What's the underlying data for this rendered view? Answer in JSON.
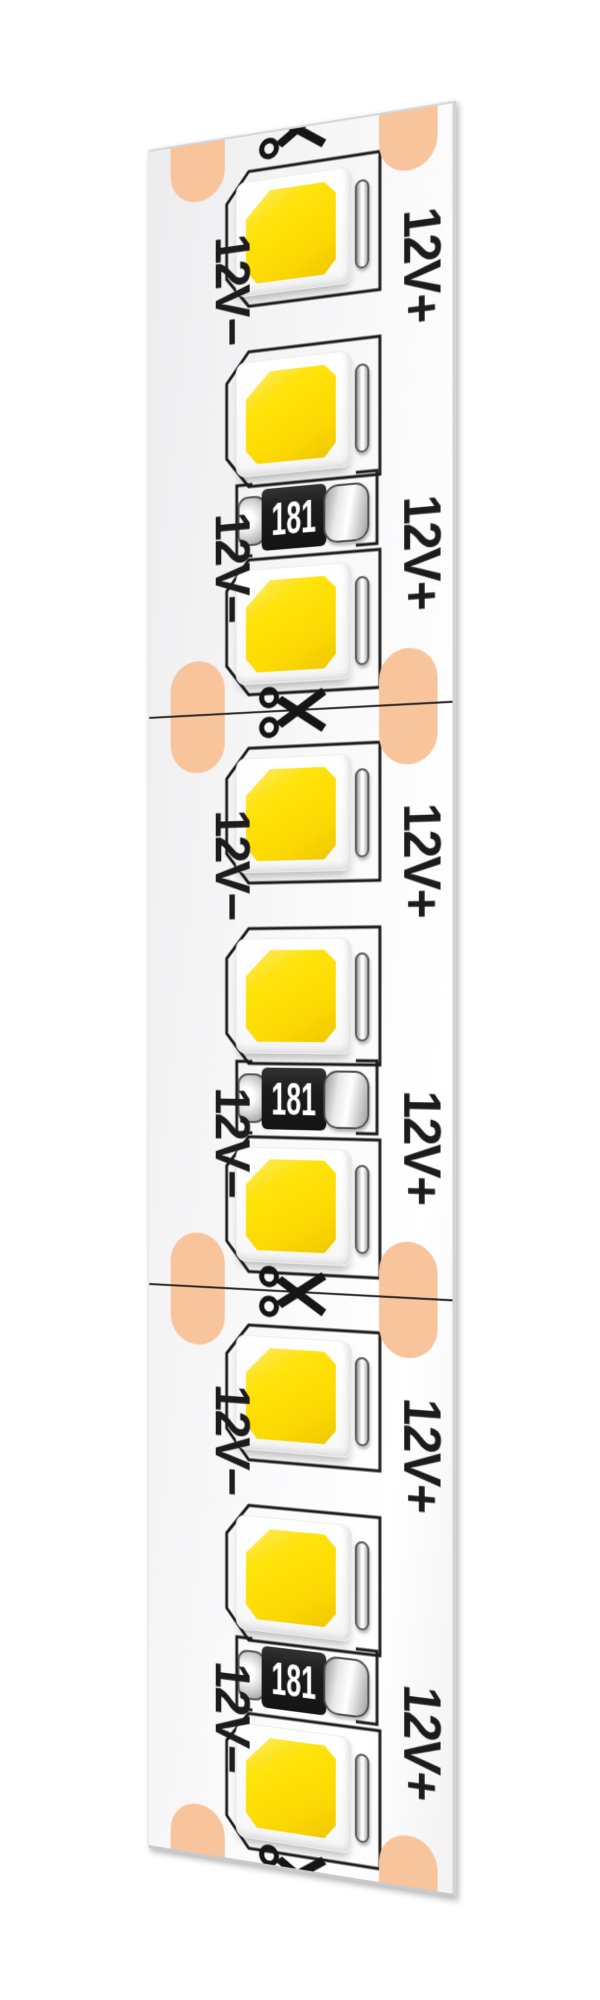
{
  "page": {
    "background": "#ffffff"
  },
  "strip": {
    "voltage_negative_label": "12V−",
    "voltage_positive_label": "12V+",
    "resistor_code": "181",
    "segment_count": 3,
    "leds_per_segment": 3,
    "resistors_per_segment": 1,
    "cut_marks_count": 4,
    "colors": {
      "pcb_face": "#f5f5f6",
      "pcb_edge": "#d4d4d6",
      "solder_pad": "#f8c49c",
      "led_phosphor": "#ffe30a",
      "led_package": "#ffffff",
      "silkscreen": "#1b1b1b",
      "resistor_body": "#1c1c1c",
      "resistor_text": "#ffffff",
      "terminal_silver": "#e9e9e9",
      "cut_line": "#2a2a2a"
    }
  }
}
